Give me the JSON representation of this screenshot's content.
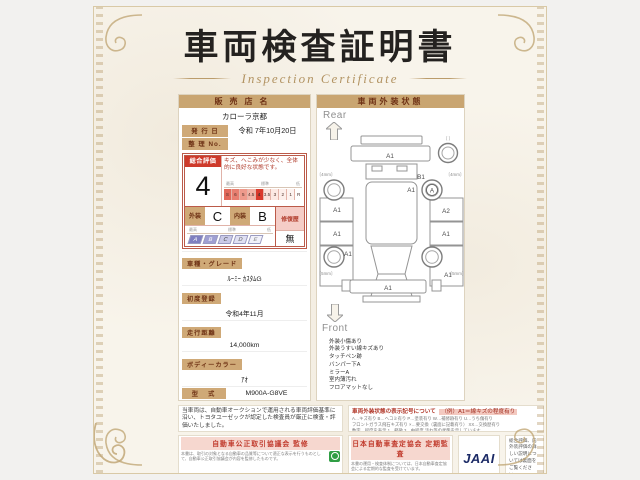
{
  "page": {
    "title": "車両検査証明書",
    "subtitle": "Inspection Certificate"
  },
  "colors": {
    "accent_red": "#ce3a2b",
    "tan_header": "#c9a571",
    "navy_logo": "#1b2a66",
    "seal_green": "#2f9e44",
    "paper_cream": "#f8f4eb"
  },
  "dealer": {
    "header": "販売店名",
    "name": "カローラ京都",
    "issue_label": "発 行 日",
    "issue_value": "令和 7年10月20日",
    "ref_label": "整 理 No.",
    "ref_value": ""
  },
  "evaluation": {
    "header": "総合評価",
    "grade": "4",
    "comment": "キズ、へこみが少なく、全体的に良好な状態です。",
    "scale_high": "最高",
    "scale_mid": "標準",
    "scale_low": "低",
    "grade_scale": [
      "S",
      "6",
      "5",
      "4.5",
      "4",
      "3.5",
      "3",
      "2",
      "1",
      "R"
    ],
    "exterior_label": "外装",
    "exterior_grade": "C",
    "interior_label": "内装",
    "interior_grade": "B",
    "letter_scale": [
      "A",
      "B",
      "C",
      "D",
      "E"
    ],
    "repair_label": "修復歴",
    "repair_value": "無"
  },
  "fields": [
    {
      "label": "車種・グレード",
      "value": "ﾙｰﾐｰ ｶｽﾀﾑG"
    },
    {
      "label": "初度登録",
      "value": "令和4年11月"
    },
    {
      "label": "走行距離",
      "value": "14,000km"
    },
    {
      "label": "ボディーカラー",
      "value": "ｱｵ"
    },
    {
      "label": "型　式",
      "value": "M900A-G8VE"
    },
    {
      "label": "車台番号",
      "value": "XXXXXXX200"
    },
    {
      "label": "エンジン",
      "value": "ｶﾞｿﾘﾝ"
    }
  ],
  "certify": {
    "logo": "TOYOTA",
    "badge": "トヨタ認定車両検査員",
    "inspector_no": "XXXXXX"
  },
  "exterior": {
    "header": "車両外装状態",
    "rear_label": "Rear",
    "front_label": "Front",
    "markers": [
      {
        "id": "rear-bumper",
        "label": "A1"
      },
      {
        "id": "spare-tire-bracket",
        "label": "〔 〕"
      },
      {
        "id": "rear-left-tread",
        "label": "〔4mm〕"
      },
      {
        "id": "rear-right-tread",
        "label": "〔4mm〕"
      },
      {
        "id": "right-rear-quarter",
        "label": "B1"
      },
      {
        "id": "right-rear-door",
        "label": "A1"
      },
      {
        "id": "right-rear-wheel",
        "label": "A"
      },
      {
        "id": "right-side-upper",
        "label": "A2"
      },
      {
        "id": "left-side-upper",
        "label": "A1"
      },
      {
        "id": "left-side-mid",
        "label": "A1"
      },
      {
        "id": "right-side-mid",
        "label": "A1"
      },
      {
        "id": "left-front-fender",
        "label": "A1"
      },
      {
        "id": "right-front-fender",
        "label": "A1"
      },
      {
        "id": "front-left-tread",
        "label": "〔5mm〕"
      },
      {
        "id": "front-right-tread",
        "label": "〔5mm〕"
      },
      {
        "id": "front-bumper",
        "label": "A1"
      }
    ],
    "notes": [
      "外装小傷あり",
      "外装うすい線キズあり",
      "タッチペン跡",
      "バンパー下A",
      "ミラーA",
      "室内薄汚れ",
      "フロアマットなし"
    ]
  },
  "legend": {
    "title": "車両外装状態の表示記号について",
    "example": "（例）A1＝線キズの程度有り",
    "lines": [
      "A…キズ有り B…ヘコミ有り P…塗装有り W…補修跡有り U…うち傷有り",
      "フロントガラス飛石キズ有り ×…要交換（裏面に記載有り） XX…交換歴有り",
      "数字…程度を表示 1…軽微 3…中程度 汚れ等の状態を示しています"
    ]
  },
  "disclaimer": "当車両は、自動車オークションで運用される車両評価基準に沿い、トヨタユーゼックが認定した検査員が厳正に検査・評価いたしました。",
  "footer": {
    "council": {
      "band": "自動車公正取引協議会 監修",
      "text": "本書は、取引の対象となる自動車の品質等について適正な表示を行うものとして、自動車公正取引協議会が内容を監修したものです。"
    },
    "jaai": {
      "band": "日本自動車査定協会 定期監査",
      "text": "本書の運用・検査体制については、日本自動車査定協会による定期的な監査を受けています。",
      "logo": "JAAI"
    },
    "backside_note": "総合評価、内外装評価の詳しい説明については裏面をご覧ください。"
  }
}
